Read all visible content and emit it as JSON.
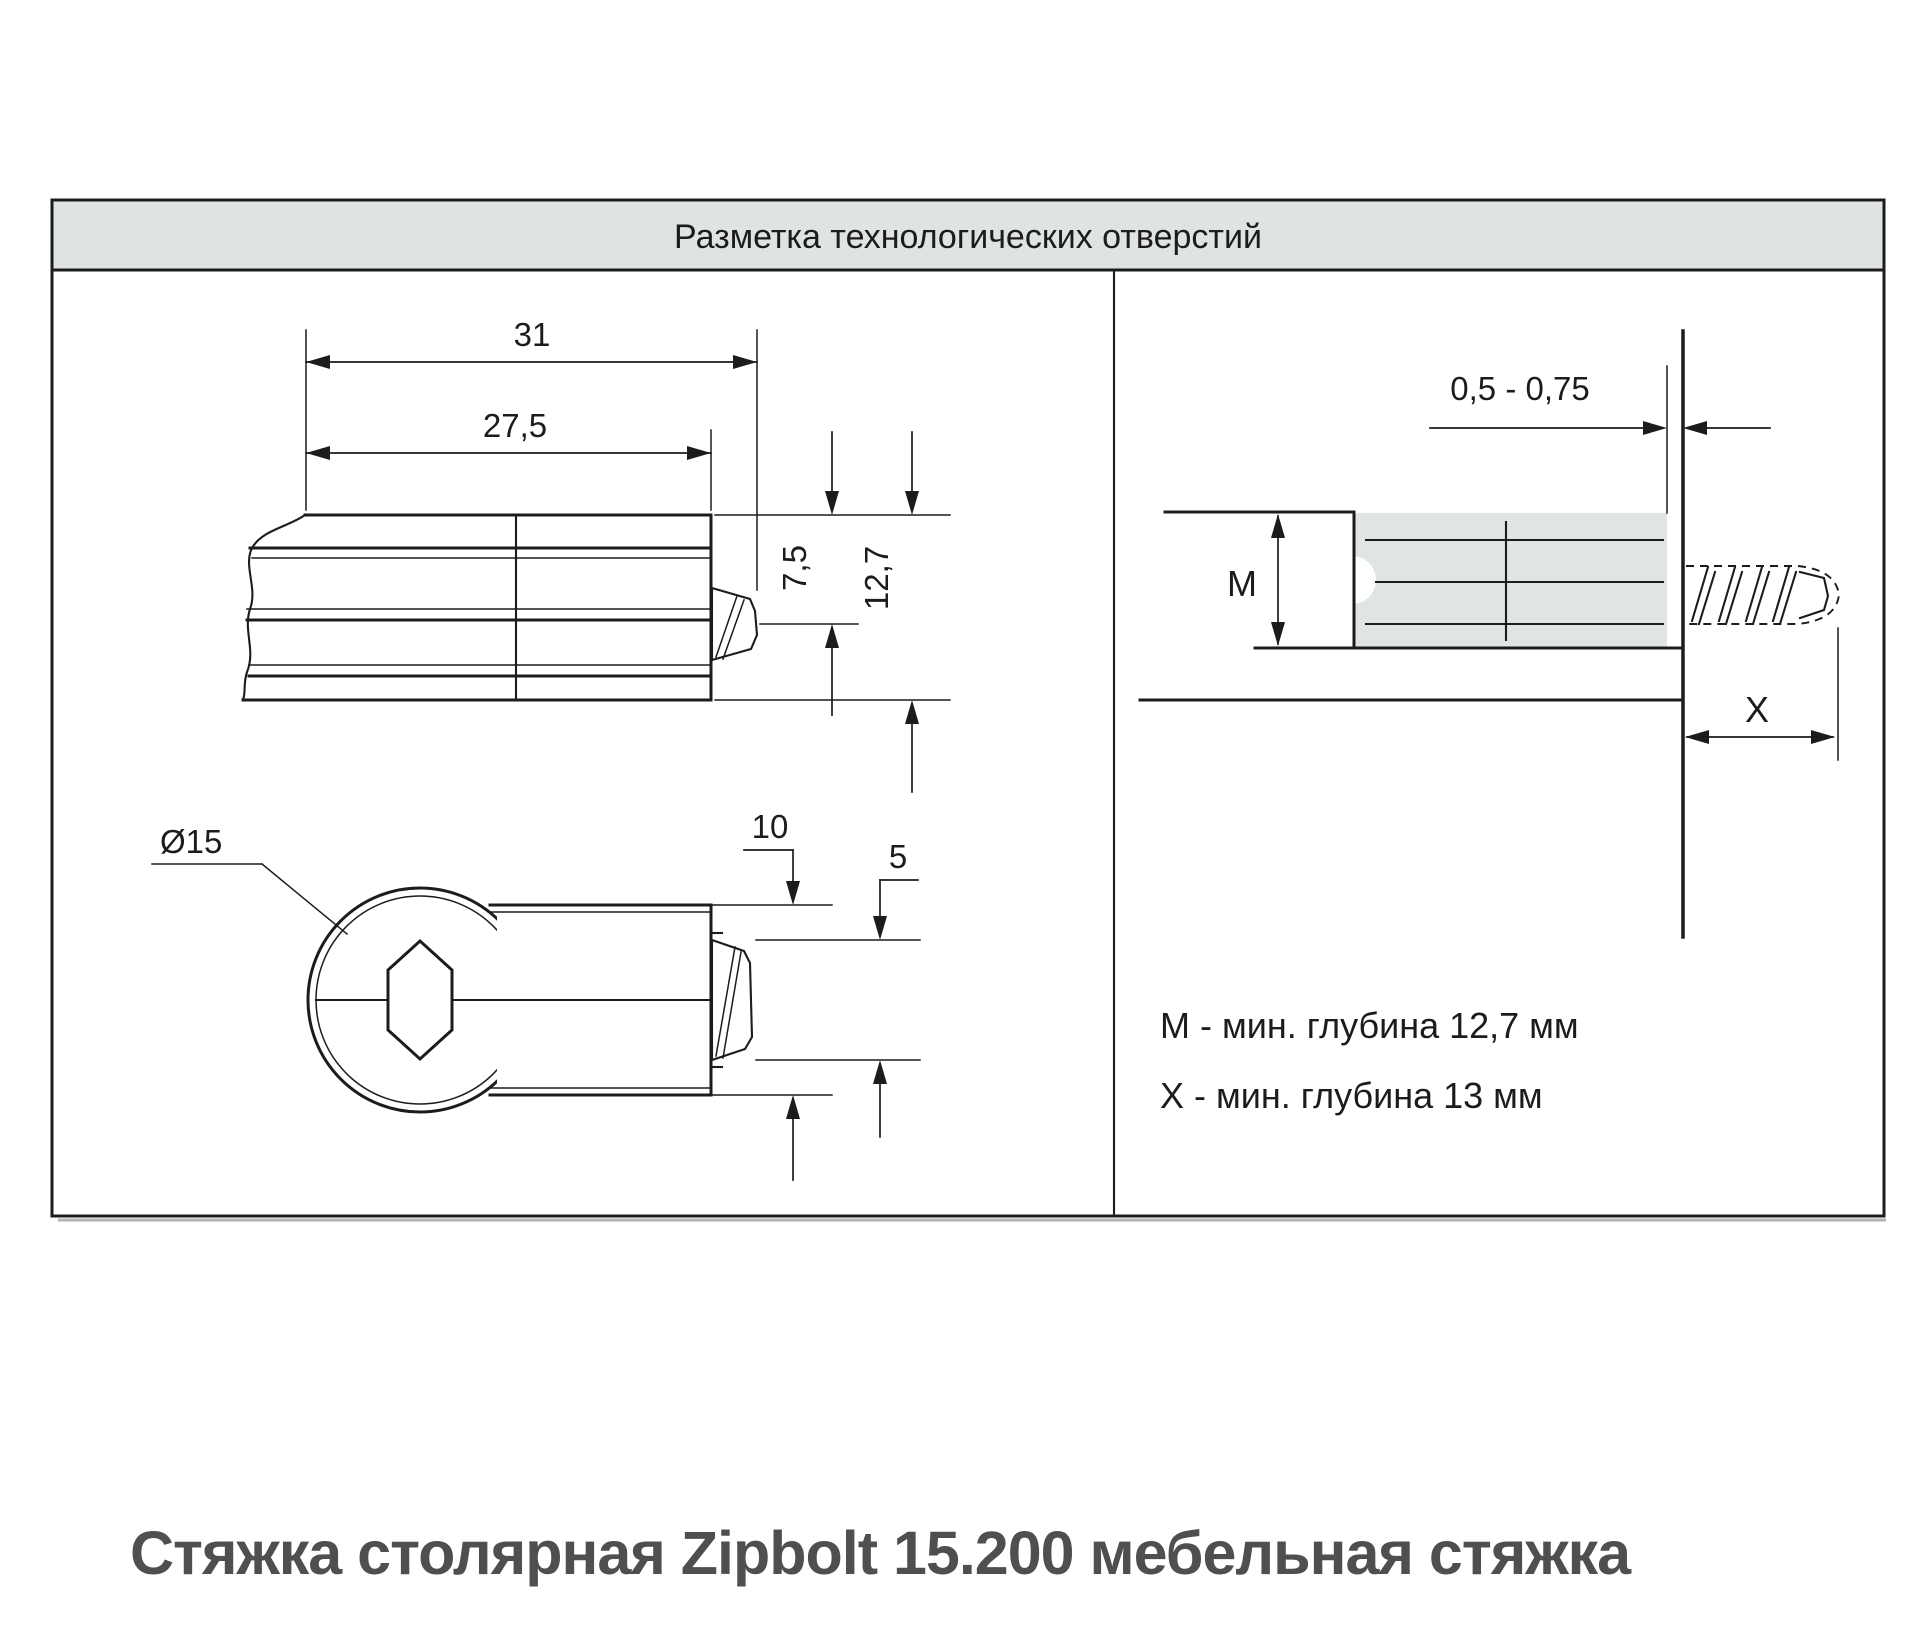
{
  "colors": {
    "panel_bg": "#dfe4e3",
    "shade": "#dfe5e2",
    "line": "#1c1c1c",
    "caption": "#4f4f4f",
    "shadow": "#b3b3b3",
    "bg": "#ffffff"
  },
  "title_bar": {
    "title": "Разметка технологических отверстий"
  },
  "side_view": {
    "length_total": "31",
    "length_body": "27,5",
    "height_upper": "7,5",
    "height_total": "12,7"
  },
  "top_view": {
    "diameter": "Ø15",
    "latch_offset_outer": "10",
    "latch_offset_inner": "5"
  },
  "section_view": {
    "protrusion_range": "0,5 - 0,75",
    "depth_m_label": "М",
    "depth_x_label": "X"
  },
  "notes": {
    "m": "М - мин. глубина 12,7 мм",
    "x": "Х - мин. глубина 13 мм"
  },
  "caption": "Стяжка столярная Zipbolt 15.200 мебельная стяжка"
}
